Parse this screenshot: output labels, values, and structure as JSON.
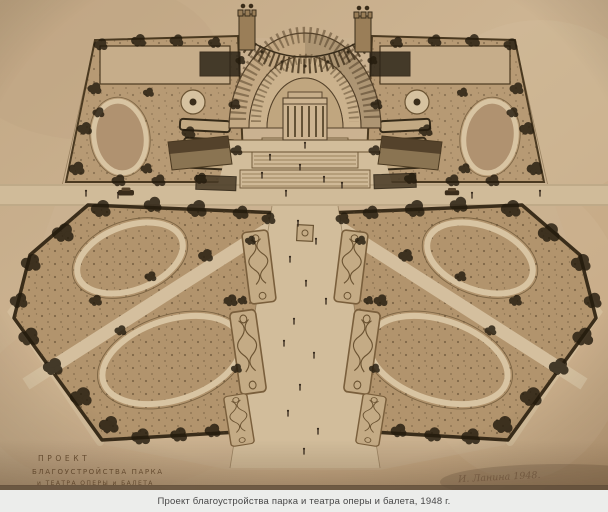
{
  "caption": {
    "text": "Проект благоустройства парка и театра оперы и балета, 1948 г."
  },
  "drawing": {
    "title_line1": "ПРОЕКТ",
    "title_line2": "БЛАГОУСТРОЙСТВА  ПАРКА",
    "title_line3": "и ТЕАТРА ОПЕРЫ и БАЛЕТА",
    "signature": "И. Ланина 1948."
  },
  "colors": {
    "photo_paper": "#c7ae8c",
    "ink": "#4a3920",
    "lawn": "#b2946d",
    "path": "#d4bf9e",
    "trees": "#241b0e",
    "caption_background": "#ecedeb",
    "caption_text": "#474747"
  }
}
